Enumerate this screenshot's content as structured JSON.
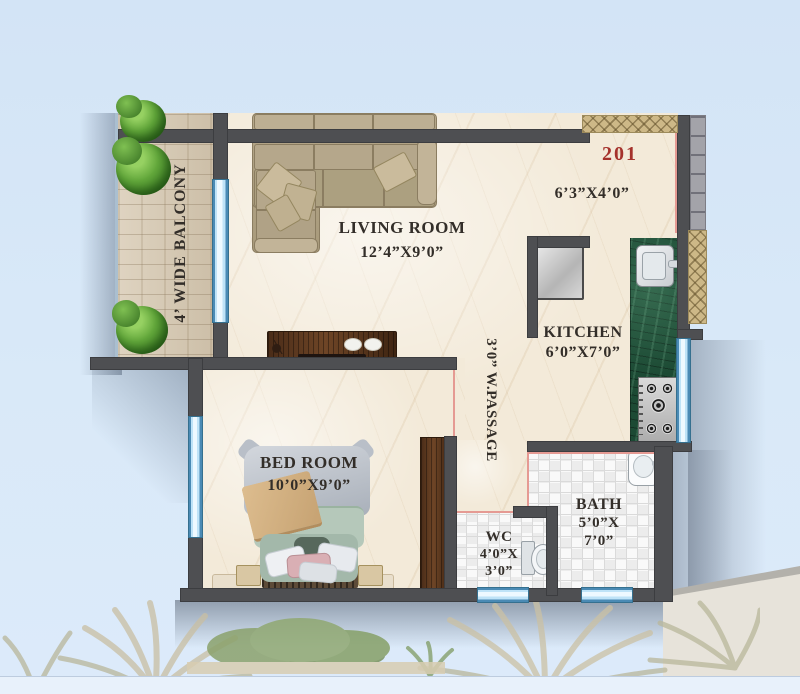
{
  "unit": {
    "number": "201"
  },
  "rooms": {
    "living": {
      "name": "LIVING ROOM",
      "dims": "12’4”X9’0”"
    },
    "kitchen": {
      "name": "KITCHEN",
      "dims": "6’0”X7’0”"
    },
    "bedroom": {
      "name": "BED ROOM",
      "dims": "10’0”X9’0”"
    },
    "bath": {
      "name": "BATH",
      "dims_line1": "5’0”X",
      "dims_line2": "7’0”"
    },
    "wc": {
      "name": "WC",
      "dims_line1": "4’0”X",
      "dims_line2": "3’0”"
    },
    "foyer": {
      "dims": "6’3”X4’0”"
    },
    "balcony": {
      "label": "4’ WIDE BALCONY"
    },
    "passage": {
      "label": "3’0” W.PASSAGE"
    }
  },
  "colors": {
    "background": "#d7e7f7",
    "wall": "#4e4f52",
    "marble_floor": "#f3ead9",
    "wood_floor": "#d6c7b0",
    "tile_floor": "#f6f6f6",
    "window_blue": "#bfe3f7",
    "counter_green": "#1c4a34",
    "unit_number_red": "#a5322c",
    "sofa_tan": "#b0a185",
    "furniture_wood_dark": "#5a3a26",
    "shrub_green": "#4f9330"
  }
}
